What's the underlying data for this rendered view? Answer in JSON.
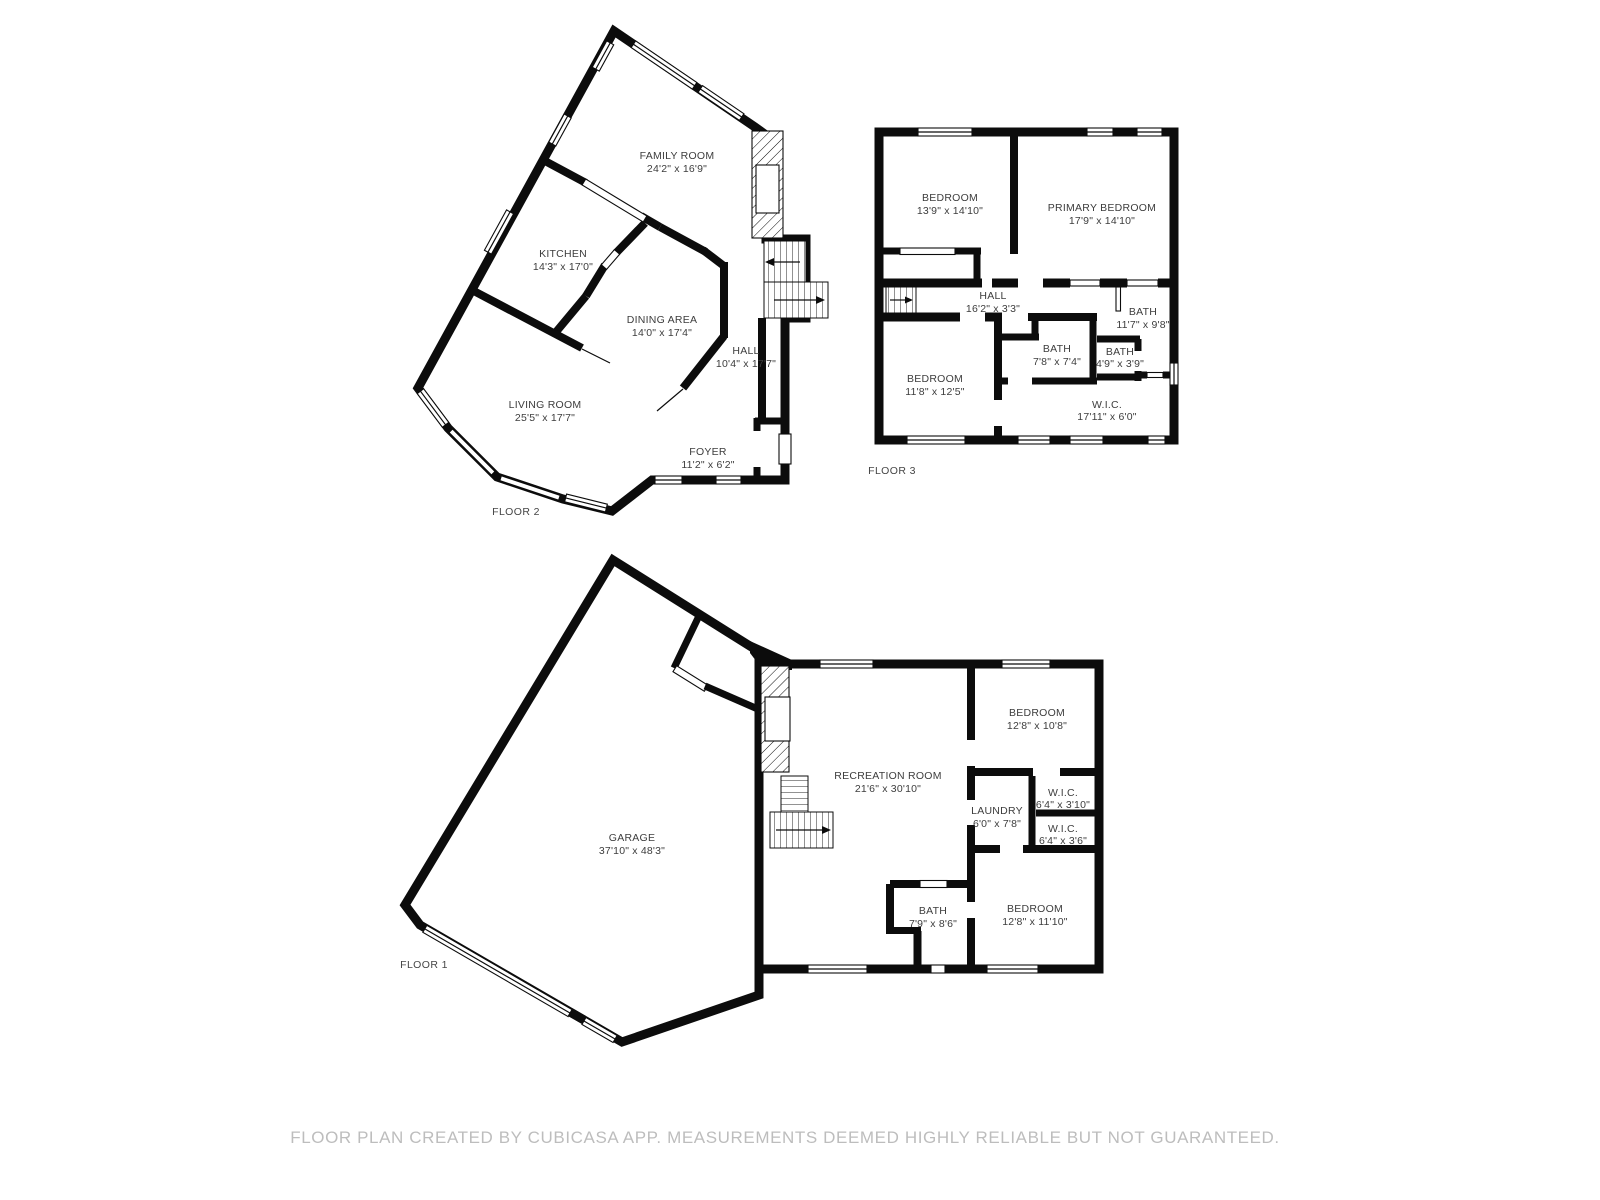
{
  "footer": {
    "text": "FLOOR PLAN CREATED BY CUBICASA APP. MEASUREMENTS DEEMED HIGHLY RELIABLE BUT NOT GUARANTEED."
  },
  "colors": {
    "wall": "#0c0c0c",
    "room_text": "#3d3d3d",
    "footer_text": "#bdbdbd",
    "background": "#ffffff"
  },
  "floors": [
    {
      "label": "FLOOR 1",
      "rooms": [
        {
          "name": "GARAGE",
          "dims": "37'10\" x 48'3\""
        },
        {
          "name": "RECREATION ROOM",
          "dims": "21'6\" x 30'10\""
        },
        {
          "name": "BEDROOM",
          "dims": "12'8\" x 10'8\""
        },
        {
          "name": "W.I.C.",
          "dims": "6'4\" x 3'10\""
        },
        {
          "name": "LAUNDRY",
          "dims": "6'0\" x 7'8\""
        },
        {
          "name": "W.I.C.",
          "dims": "6'4\" x 3'6\""
        },
        {
          "name": "BATH",
          "dims": "7'9\" x 8'6\""
        },
        {
          "name": "BEDROOM",
          "dims": "12'8\" x 11'10\""
        }
      ]
    },
    {
      "label": "FLOOR 2",
      "rooms": [
        {
          "name": "FAMILY ROOM",
          "dims": "24'2\" x 16'9\""
        },
        {
          "name": "KITCHEN",
          "dims": "14'3\" x 17'0\""
        },
        {
          "name": "DINING AREA",
          "dims": "14'0\" x 17'4\""
        },
        {
          "name": "HALL",
          "dims": "10'4\" x 17'7\""
        },
        {
          "name": "LIVING ROOM",
          "dims": "25'5\" x 17'7\""
        },
        {
          "name": "FOYER",
          "dims": "11'2\" x 6'2\""
        }
      ]
    },
    {
      "label": "FLOOR 3",
      "rooms": [
        {
          "name": "BEDROOM",
          "dims": "13'9\" x 14'10\""
        },
        {
          "name": "PRIMARY BEDROOM",
          "dims": "17'9\" x 14'10\""
        },
        {
          "name": "HALL",
          "dims": "16'2\" x 3'3\""
        },
        {
          "name": "BATH",
          "dims": "11'7\" x 9'8\""
        },
        {
          "name": "BATH",
          "dims": "7'8\" x 7'4\""
        },
        {
          "name": "BATH",
          "dims": "4'9\" x 3'9\""
        },
        {
          "name": "BEDROOM",
          "dims": "11'8\" x 12'5\""
        },
        {
          "name": "W.I.C.",
          "dims": "17'11\" x 6'0\""
        }
      ]
    }
  ]
}
